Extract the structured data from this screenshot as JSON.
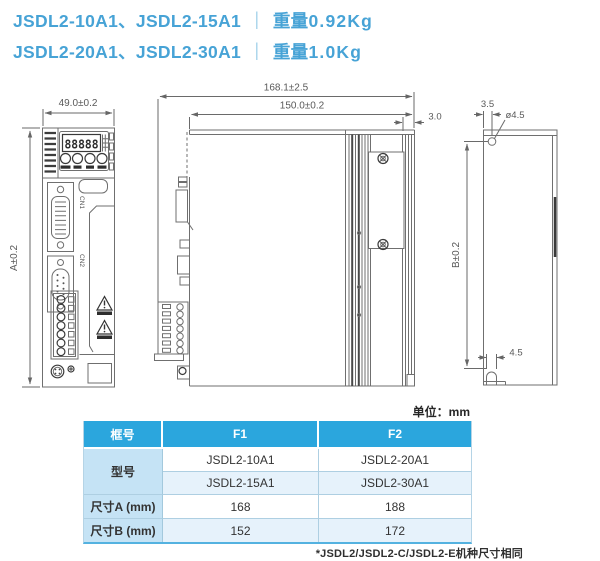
{
  "title": {
    "line1": {
      "models": "JSDL2-10A1、JSDL2-15A1",
      "divider": "｜",
      "weight_label": "重量",
      "weight_value": "0.92Kg"
    },
    "line2": {
      "models": "JSDL2-20A1、JSDL2-30A1",
      "divider": "｜",
      "weight_label": "重量",
      "weight_value": "1.0Kg"
    }
  },
  "drawing": {
    "front_view": {
      "width_dim": "49.0±0.2",
      "height_dim": "A±0.2",
      "display_digits": "88888",
      "cn1_label": "CN1",
      "cn2_label": "CN2"
    },
    "side_view": {
      "overall_depth_dim": "168.1±2.5",
      "body_depth_dim": "150.0±0.2",
      "fin_depth_dim": "3.0"
    },
    "back_view": {
      "hole_offset_dim": "3.5",
      "hole_diameter_dim": "ø4.5",
      "height_dim": "B±0.2",
      "notch_width_dim": "4.5"
    }
  },
  "units_label": "单位：mm",
  "table": {
    "headers": [
      "框号",
      "F1",
      "F2"
    ],
    "model_label": "型号",
    "model_rows": [
      {
        "f1": "JSDL2-10A1",
        "f2": "JSDL2-20A1"
      },
      {
        "f1": "JSDL2-15A1",
        "f2": "JSDL2-30A1"
      }
    ],
    "dim_a": {
      "label": "尺寸A (mm)",
      "f1": "168",
      "f2": "188"
    },
    "dim_b": {
      "label": "尺寸B (mm)",
      "f1": "152",
      "f2": "172"
    }
  },
  "footnote": "*JSDL2/JSDL2-C/JSDL2-E机种尺寸相同",
  "colors": {
    "title_blue": "#47a3d6",
    "table_header_blue": "#2ba6dd",
    "table_label_blue": "#c5e3f5",
    "table_alt_row_blue": "#e6f2fb",
    "drawing_line_gray": "#6f6f6f"
  }
}
